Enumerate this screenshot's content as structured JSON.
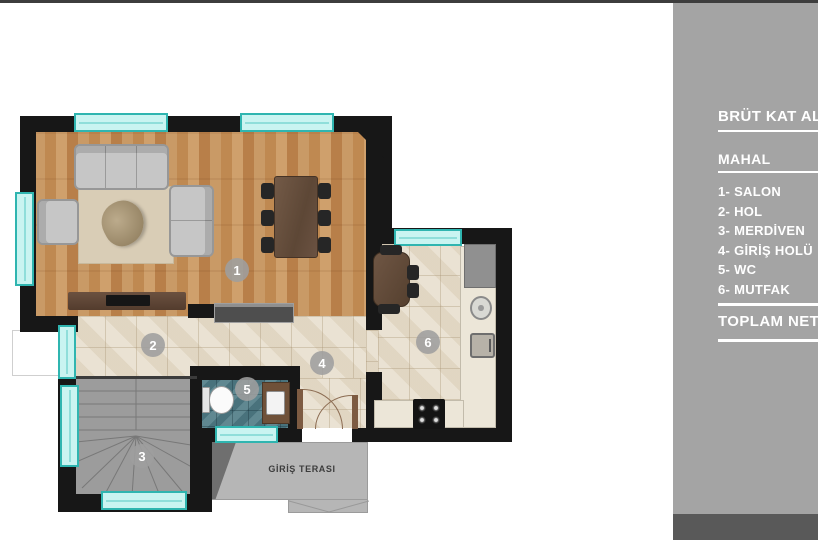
{
  "sidebar": {
    "title": "BRÜT KAT ALA",
    "section_label": "MAHAL",
    "legend": [
      "1- SALON",
      "2- HOL",
      "3- MERDİVEN",
      "4- GİRİŞ HOLÜ",
      "5- WC",
      "6- MUTFAK"
    ],
    "total_label": "TOPLAM NET"
  },
  "plan": {
    "room_labels": [
      "1",
      "2",
      "3",
      "4",
      "5",
      "6"
    ],
    "terrace_label": "GİRİŞ TERASI"
  },
  "colors": {
    "sidebar_gray": "#a4a4a4",
    "sidebar_footer_gray": "#595959",
    "wall_black": "#171717",
    "window_cyan": "#c9f4f1",
    "window_border_cyan": "#2fb5b0",
    "wood_floor": "#c3905a",
    "tile_beige": "#e8dfce",
    "wc_teal": "#527e88",
    "stairs_gray": "#9c9c9c",
    "terrace_gray": "#b6b6b6"
  }
}
